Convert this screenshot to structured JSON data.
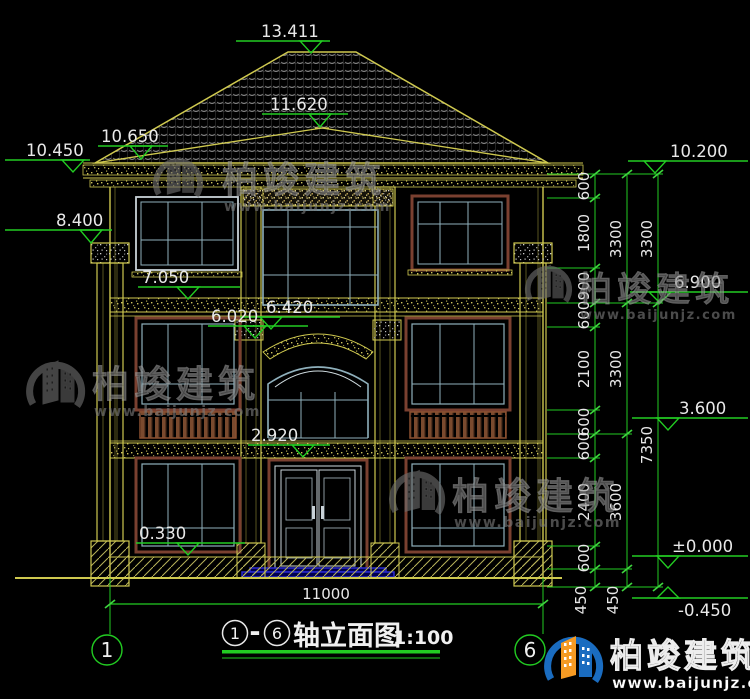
{
  "drawing": {
    "title": {
      "axis_start": "1",
      "separator": "-",
      "axis_end": "6",
      "name": "轴立面图",
      "scale": "1:100"
    },
    "overall_width": "11000",
    "axis_bubbles": [
      "1",
      "6"
    ],
    "elevations": {
      "roof_ridge": "13.411",
      "porch_ridge": "11.620",
      "left_roof_eave": "10.650",
      "left_eave": "10.450",
      "right_eave": "10.200",
      "pilaster_capital": "8.400",
      "floor3_sill": "7.050",
      "floor3_level": "6.900",
      "floor2_band_top": "6.420",
      "floor2_band_bottom": "6.020",
      "floor2_level": "3.600",
      "floor1_lintel": "2.920",
      "window_sill": "0.330",
      "ground_floor": "±0.000",
      "site_level": "-0.450"
    },
    "dims_inner": [
      "600",
      "1800",
      "900",
      "600",
      "2100",
      "600",
      "600",
      "2400",
      "600",
      "450"
    ],
    "dims_mid": [
      "3300",
      "3300",
      "3600",
      "450"
    ],
    "dims_outer": [
      "3300",
      "7350"
    ]
  },
  "watermark": {
    "name": "柏竣建筑",
    "url": "www.baijunjz.com"
  },
  "logo": {
    "name": "柏竣建筑",
    "url": "www.baijunjz.com"
  },
  "colors": {
    "background": "#000000",
    "cad_yellow": "#cfc94f",
    "cad_green": "#22cc22",
    "tick_green": "#3ed43e",
    "dim_text": "#e8e8e8",
    "window_frame_brown": "#7a4030",
    "mullion_blue": "#8fb0bc",
    "steps_blue": "#2a2ad0",
    "logo_blue": "#1a6cc0",
    "logo_orange": "#f59a23"
  }
}
